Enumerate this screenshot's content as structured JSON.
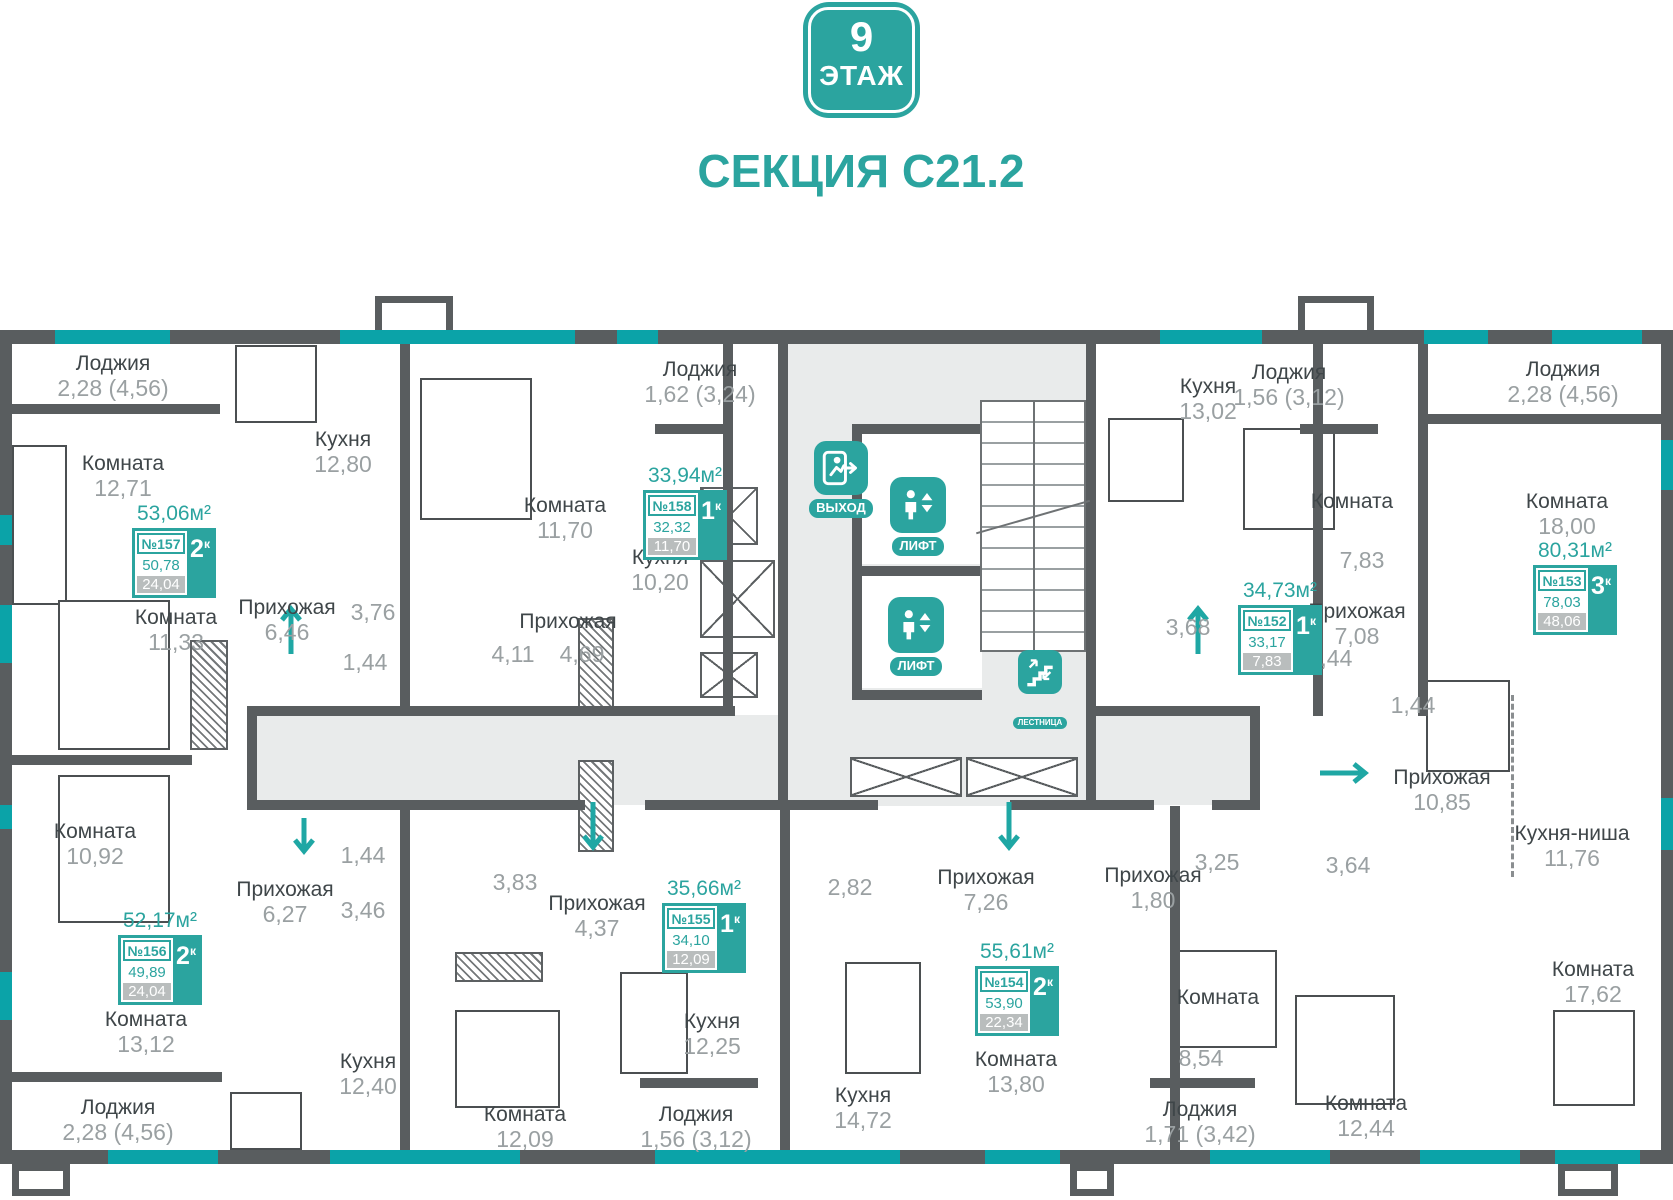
{
  "header": {
    "floor_number": "9",
    "floor_word": "ЭТАЖ",
    "section_title": "СЕКЦИЯ С21.2"
  },
  "colors": {
    "accent": "#2ba49f",
    "wall": "#595d5f",
    "window": "#0ba3a8",
    "corridor": "#e9ebeb"
  },
  "icons": {
    "exit_label": "ВЫХОД",
    "lift_label": "ЛИФТ",
    "stairs_label": "ЛЕСТНИЦА"
  },
  "labels": [
    {
      "x": 113,
      "y": 352,
      "name": "Лоджия",
      "area": "2,28 (4,56)"
    },
    {
      "x": 123,
      "y": 452,
      "name": "Комната",
      "area": "12,71"
    },
    {
      "x": 343,
      "y": 428,
      "name": "Кухня",
      "area": "12,80"
    },
    {
      "x": 287,
      "y": 596,
      "name": "Прихожая",
      "area": "6,46"
    },
    {
      "x": 373,
      "y": 600,
      "area": "3,76"
    },
    {
      "x": 176,
      "y": 606,
      "name": "Комната",
      "area": "11,33"
    },
    {
      "x": 365,
      "y": 650,
      "area": "1,44"
    },
    {
      "x": 95,
      "y": 820,
      "name": "Комната",
      "area": "10,92"
    },
    {
      "x": 565,
      "y": 494,
      "name": "Комната",
      "area": "11,70"
    },
    {
      "x": 660,
      "y": 546,
      "name": "Кухня",
      "area": "10,20"
    },
    {
      "x": 568,
      "y": 610,
      "name": "Прихожая"
    },
    {
      "x": 513,
      "y": 642,
      "area": "4,11"
    },
    {
      "x": 582,
      "y": 642,
      "area": "4,69"
    },
    {
      "x": 700,
      "y": 358,
      "name": "Лоджия",
      "area": "1,62 (3,24)"
    },
    {
      "x": 1208,
      "y": 375,
      "name": "Кухня",
      "area": "13,02"
    },
    {
      "x": 1289,
      "y": 361,
      "name": "Лоджия",
      "area": "1,56 (3,12)"
    },
    {
      "x": 1352,
      "y": 490,
      "name": "Комната"
    },
    {
      "x": 1362,
      "y": 548,
      "area": "7,83"
    },
    {
      "x": 1188,
      "y": 615,
      "area": "3,68"
    },
    {
      "x": 1357,
      "y": 600,
      "name": "Прихожая",
      "area": "7,08"
    },
    {
      "x": 1563,
      "y": 358,
      "name": "Лоджия",
      "area": "2,28 (4,56)"
    },
    {
      "x": 1567,
      "y": 490,
      "name": "Комната",
      "area": "18,00"
    },
    {
      "x": 1330,
      "y": 646,
      "area": "1,44"
    },
    {
      "x": 1413,
      "y": 693,
      "area": "1,44"
    },
    {
      "x": 1442,
      "y": 766,
      "name": "Прихожая",
      "area": "10,85"
    },
    {
      "x": 1572,
      "y": 822,
      "name": "Кухня-ниша",
      "area": "11,76"
    },
    {
      "x": 1153,
      "y": 864,
      "name": "Прихожая",
      "area": "1,80"
    },
    {
      "x": 1217,
      "y": 850,
      "area": "3,25"
    },
    {
      "x": 1348,
      "y": 853,
      "area": "3,64"
    },
    {
      "x": 1218,
      "y": 986,
      "name": "Комната"
    },
    {
      "x": 1201,
      "y": 1046,
      "area": "8,54"
    },
    {
      "x": 1366,
      "y": 1092,
      "name": "Комната",
      "area": "12,44"
    },
    {
      "x": 1593,
      "y": 958,
      "name": "Комната",
      "area": "17,62"
    },
    {
      "x": 1200,
      "y": 1098,
      "name": "Лоджия",
      "area": "1,71 (3,42)"
    },
    {
      "x": 863,
      "y": 1084,
      "name": "Кухня",
      "area": "14,72"
    },
    {
      "x": 1016,
      "y": 1048,
      "name": "Комната",
      "area": "13,80"
    },
    {
      "x": 525,
      "y": 1103,
      "name": "Комната",
      "area": "12,09"
    },
    {
      "x": 696,
      "y": 1103,
      "name": "Лоджия",
      "area": "1,56 (3,12)"
    },
    {
      "x": 712,
      "y": 1010,
      "name": "Кухня",
      "area": "12,25"
    },
    {
      "x": 368,
      "y": 1050,
      "name": "Кухня",
      "area": "12,40"
    },
    {
      "x": 285,
      "y": 878,
      "name": "Прихожая",
      "area": "6,27"
    },
    {
      "x": 363,
      "y": 898,
      "area": "3,46"
    },
    {
      "x": 363,
      "y": 843,
      "area": "1,44"
    },
    {
      "x": 515,
      "y": 870,
      "area": "3,83"
    },
    {
      "x": 597,
      "y": 892,
      "name": "Прихожая",
      "area": "4,37"
    },
    {
      "x": 146,
      "y": 1008,
      "name": "Комната",
      "area": "13,12"
    },
    {
      "x": 118,
      "y": 1096,
      "name": "Лоджия",
      "area": "2,28 (4,56)"
    },
    {
      "x": 850,
      "y": 875,
      "area": "2,82"
    },
    {
      "x": 986,
      "y": 866,
      "name": "Прихожая",
      "area": "7,26"
    }
  ],
  "apartments": [
    {
      "x": 132,
      "y": 528,
      "total": "53,06м²",
      "number": "№157",
      "rooms": "2",
      "k": "к",
      "live": "50,78",
      "extra": "24,04"
    },
    {
      "x": 643,
      "y": 490,
      "total": "33,94м²",
      "number": "№158",
      "rooms": "1",
      "k": "к",
      "live": "32,32",
      "extra": "11,70"
    },
    {
      "x": 1238,
      "y": 605,
      "total": "34,73м²",
      "number": "№152",
      "rooms": "1",
      "k": "к",
      "live": "33,17",
      "extra": "7,83"
    },
    {
      "x": 1533,
      "y": 565,
      "total": "80,31м²",
      "number": "№153",
      "rooms": "3",
      "k": "к",
      "live": "78,03",
      "extra": "48,06"
    },
    {
      "x": 118,
      "y": 935,
      "total": "52,17м²",
      "number": "№156",
      "rooms": "2",
      "k": "к",
      "live": "49,89",
      "extra": "24,04"
    },
    {
      "x": 662,
      "y": 903,
      "total": "35,66м²",
      "number": "№155",
      "rooms": "1",
      "k": "к",
      "live": "34,10",
      "extra": "12,09"
    },
    {
      "x": 975,
      "y": 966,
      "total": "55,61м²",
      "number": "№154",
      "rooms": "2",
      "k": "к",
      "live": "53,90",
      "extra": "22,34"
    }
  ]
}
